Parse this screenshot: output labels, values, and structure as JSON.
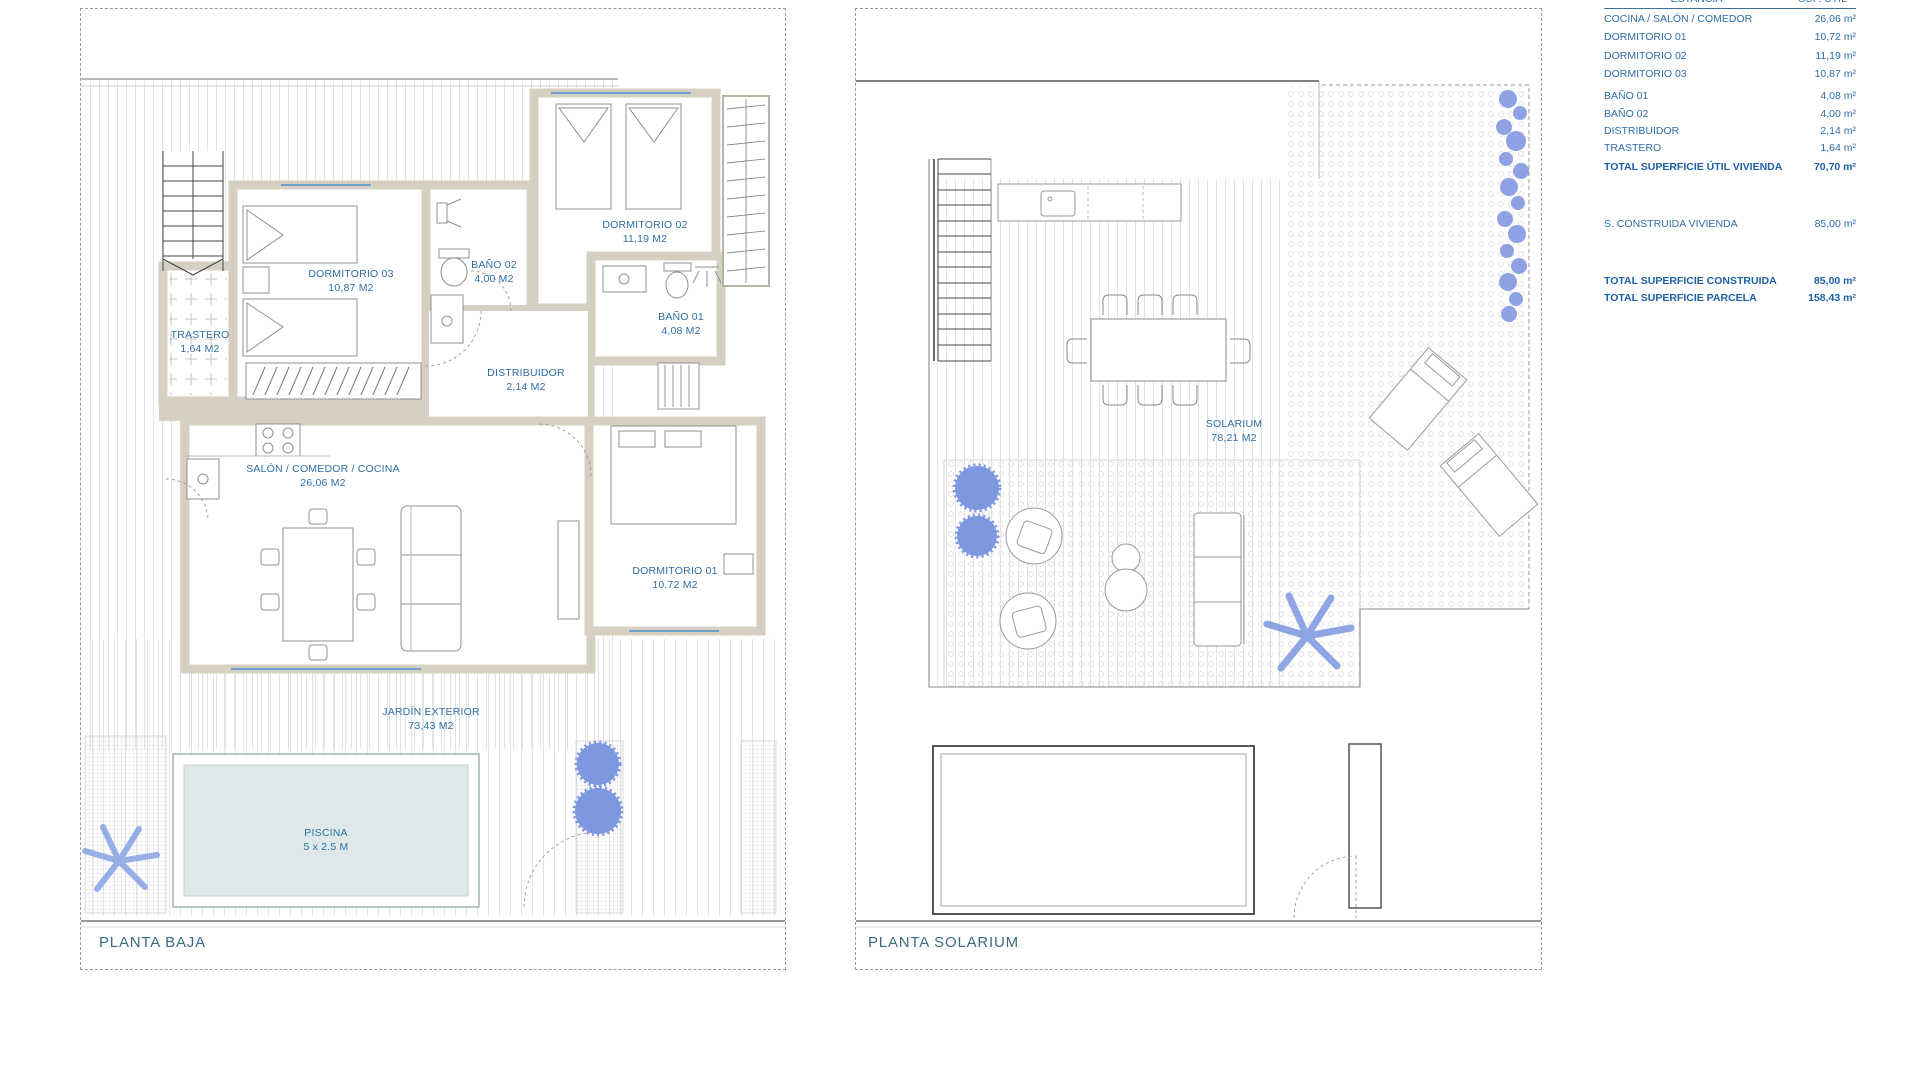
{
  "sheet": {
    "left_plan_title": "PLANTA BAJA",
    "right_plan_title": "PLANTA SOLARIUM"
  },
  "planta_baja": {
    "title": "PLANTA BAJA",
    "rooms": [
      {
        "name": "TRASTERO",
        "area": "1,64 M2"
      },
      {
        "name": "DORMITORIO 03",
        "area": "10,87 M2"
      },
      {
        "name": "BAÑO 02",
        "area": "4,00 M2"
      },
      {
        "name": "DORMITORIO 02",
        "area": "11,19 M2"
      },
      {
        "name": "BAÑO 01",
        "area": "4,08 M2"
      },
      {
        "name": "DISTRIBUIDOR",
        "area": "2,14 M2"
      },
      {
        "name": "SALÓN / COMEDOR / COCINA",
        "area": "26,06 M2"
      },
      {
        "name": "DORMITORIO 01",
        "area": "10.72 M2"
      },
      {
        "name": "JARDÍN EXTERIOR",
        "area": "73,43 M2"
      },
      {
        "name": "PISCINA",
        "area": "5 x 2.5 M"
      }
    ]
  },
  "planta_solarium": {
    "title": "PLANTA SOLARIUM",
    "rooms": [
      {
        "name": "SOLARIUM",
        "area": "78,21 M2"
      }
    ]
  },
  "summary_table": {
    "header": {
      "estancia": "ESTANCIA",
      "sup_util": "SUP. ÚTIL"
    },
    "rows": [
      {
        "label": "COCINA / SALÓN / COMEDOR",
        "value": "26,06 m²"
      },
      {
        "label": "DORMITORIO 01",
        "value": "10,72 m²"
      },
      {
        "label": "DORMITORIO 02",
        "value": "11,19 m²"
      },
      {
        "label": "DORMITORIO 03",
        "value": "10,87 m²"
      },
      {
        "label": "BAÑO 01",
        "value": "4,08 m²"
      },
      {
        "label": "BAÑO 02",
        "value": "4,00 m²"
      },
      {
        "label": "DISTRIBUIDOR",
        "value": "2,14 m²"
      },
      {
        "label": "TRASTERO",
        "value": "1,64 m²"
      }
    ],
    "total_util": {
      "label": "TOTAL SUPERFICIE ÚTIL VIVIENDA",
      "value": "70,70 m²"
    },
    "construida": {
      "label": "S. CONSTRUIDA VIVIENDA",
      "value": "85,00 m²"
    },
    "total_construida": {
      "label": "TOTAL SUPERFICIE CONSTRUIDA",
      "value": "85,00 m²"
    },
    "total_parcela": {
      "label": "TOTAL SUPERFICIE PARCELA",
      "value": "158,43 m²"
    }
  },
  "colors": {
    "label_blue": "#2e6ea6",
    "total_blue": "#1e5fa6",
    "title_teal": "#3c6b80",
    "wall_beige": "#d5d0c2",
    "pool_fill": "#dfe8e8",
    "plant_blue": "#7d97e0"
  }
}
